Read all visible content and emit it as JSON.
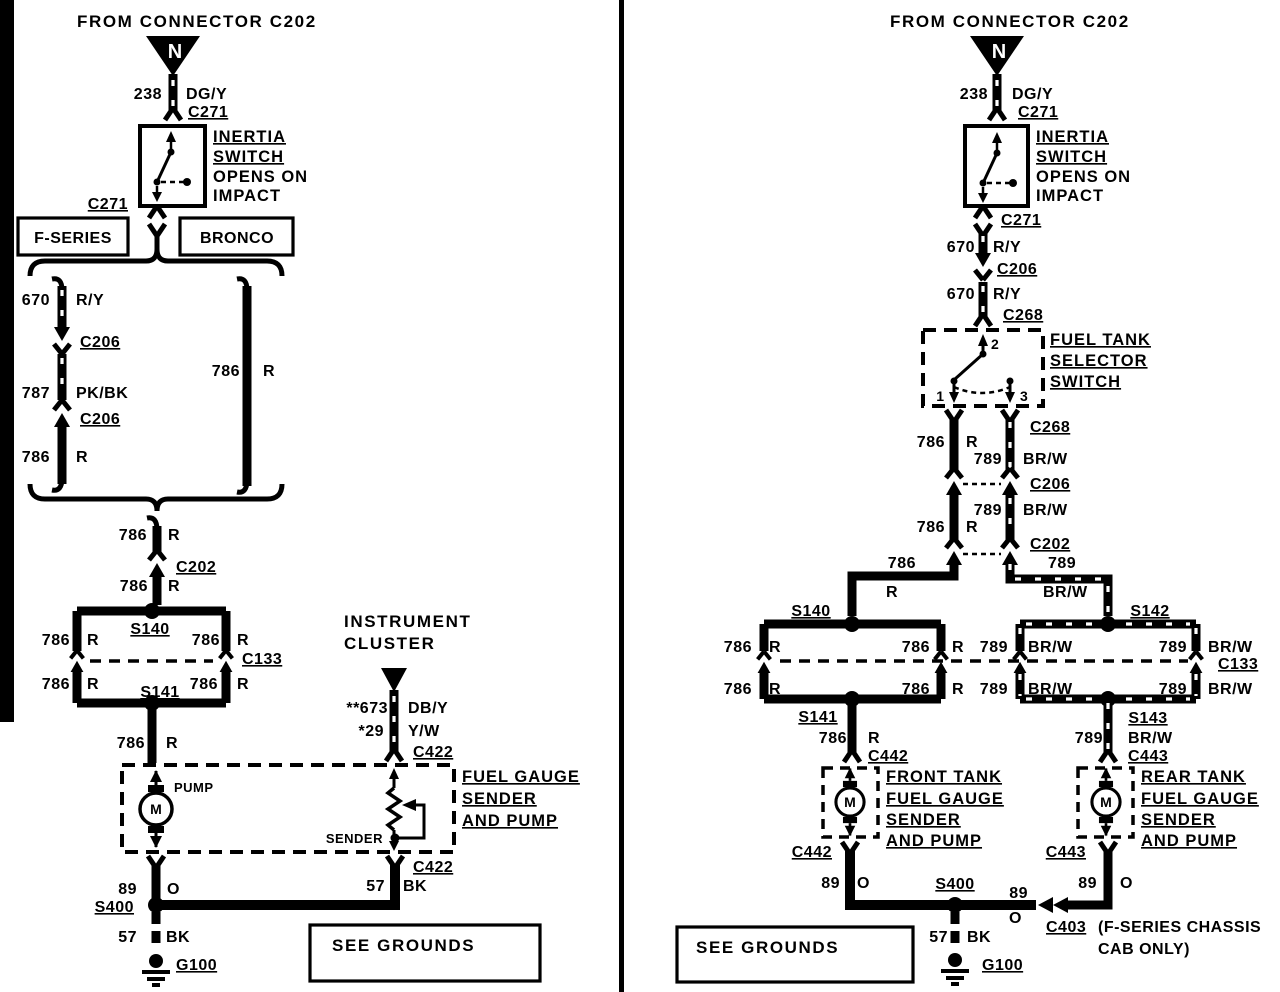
{
  "page": {
    "bg": "#ffffff",
    "ink": "#000000"
  },
  "left": {
    "header": "FROM CONNECTOR C202",
    "triangle": "N",
    "labels": {
      "w238n": "238",
      "w238c": "DG/Y",
      "c271a": "C271",
      "inertia1": "INERTIA",
      "inertia2": "SWITCH",
      "inertia3": "OPENS ON",
      "inertia4": "IMPACT",
      "c271b": "C271",
      "fseries": "F-SERIES",
      "bronco": "BRONCO",
      "w670n": "670",
      "w670c": "R/Y",
      "c206a": "C206",
      "w787n": "787",
      "w787c": "PK/BK",
      "c206b": "C206",
      "w786an": "786",
      "w786ac": "R",
      "w786bn": "786",
      "w786bc": "R",
      "w786cn": "786",
      "w786cc": "R",
      "c202": "C202",
      "w786dn": "786",
      "w786dc": "R",
      "s140": "S140",
      "ul_n": "786",
      "ul_c": "R",
      "ur_n": "786",
      "ur_c": "R",
      "c133": "C133",
      "ll_n": "786",
      "ll_c": "R",
      "lr_n": "786",
      "lr_c": "R",
      "s141": "S141",
      "w786en": "786",
      "w786ec": "R",
      "instr1": "INSTRUMENT",
      "instr2": "CLUSTER",
      "w673n": "**673",
      "w673c": "DB/Y",
      "w29n": "*29",
      "w29c": "Y/W",
      "c422a": "C422",
      "pump": "PUMP",
      "motor": "M",
      "sender": "SENDER",
      "fg1": "FUEL GAUGE",
      "fg2": "SENDER",
      "fg3": "AND PUMP",
      "c422b": "C422",
      "w89n": "89",
      "w89c": "O",
      "w57an": "57",
      "w57ac": "BK",
      "s400": "S400",
      "w57bn": "57",
      "w57bc": "BK",
      "g100": "G100",
      "seegrounds": "SEE GROUNDS"
    }
  },
  "right": {
    "header": "FROM CONNECTOR C202",
    "triangle": "N",
    "labels": {
      "w238n": "238",
      "w238c": "DG/Y",
      "c271a": "C271",
      "inertia1": "INERTIA",
      "inertia2": "SWITCH",
      "inertia3": "OPENS ON",
      "inertia4": "IMPACT",
      "c271b": "C271",
      "w670an": "670",
      "w670ac": "R/Y",
      "c206a": "C206",
      "w670bn": "670",
      "w670bc": "R/Y",
      "c268a": "C268",
      "t1": "1",
      "t2": "2",
      "t3": "3",
      "sel1": "FUEL TANK",
      "sel2": "SELECTOR",
      "sel3": "SWITCH",
      "c268b": "C268",
      "w786an": "786",
      "w786ac": "R",
      "w789an": "789",
      "w789ac": "BR/W",
      "c206b": "C206",
      "w789bn": "789",
      "w789bc": "BR/W",
      "w786bn": "786",
      "w786bc": "R",
      "c202": "C202",
      "w786cn": "786",
      "w786cc": "R",
      "w789cn": "789",
      "w789cc": "BR/W",
      "s140": "S140",
      "s142": "S142",
      "l_ul_n": "786",
      "l_ul_c": "R",
      "l_ur_n": "786",
      "l_ur_c": "R",
      "l_ll_n": "786",
      "l_ll_c": "R",
      "l_lr_n": "786",
      "l_lr_c": "R",
      "r_ul_n": "789",
      "r_ul_c": "BR/W",
      "r_ur_n": "789",
      "r_ur_c": "BR/W",
      "c133": "C133",
      "r_ll_n": "789",
      "r_ll_c": "BR/W",
      "r_lr_n": "789",
      "r_lr_c": "BR/W",
      "s141": "S141",
      "w786dn": "786",
      "w786dc": "R",
      "c442a": "C442",
      "s143": "S143",
      "w789dn": "789",
      "w789dc": "BR/W",
      "c443a": "C443",
      "front1": "FRONT TANK",
      "front2": "FUEL GAUGE",
      "front3": "SENDER",
      "front4": "AND PUMP",
      "motor_f": "M",
      "rear1": "REAR TANK",
      "rear2": "FUEL GAUGE",
      "rear3": "SENDER",
      "rear4": "AND PUMP",
      "motor_r": "M",
      "c442b": "C442",
      "w89an": "89",
      "w89ac": "O",
      "s400": "S400",
      "w89bn": "89",
      "w89bc": "O",
      "c443b": "C443",
      "w89cn": "89",
      "w89cc": "O",
      "c403": "C403",
      "note1": "(F-SERIES CHASSIS",
      "note2": "CAB ONLY)",
      "w57n": "57",
      "w57c": "BK",
      "g100": "G100",
      "seegrounds": "SEE GROUNDS"
    }
  }
}
